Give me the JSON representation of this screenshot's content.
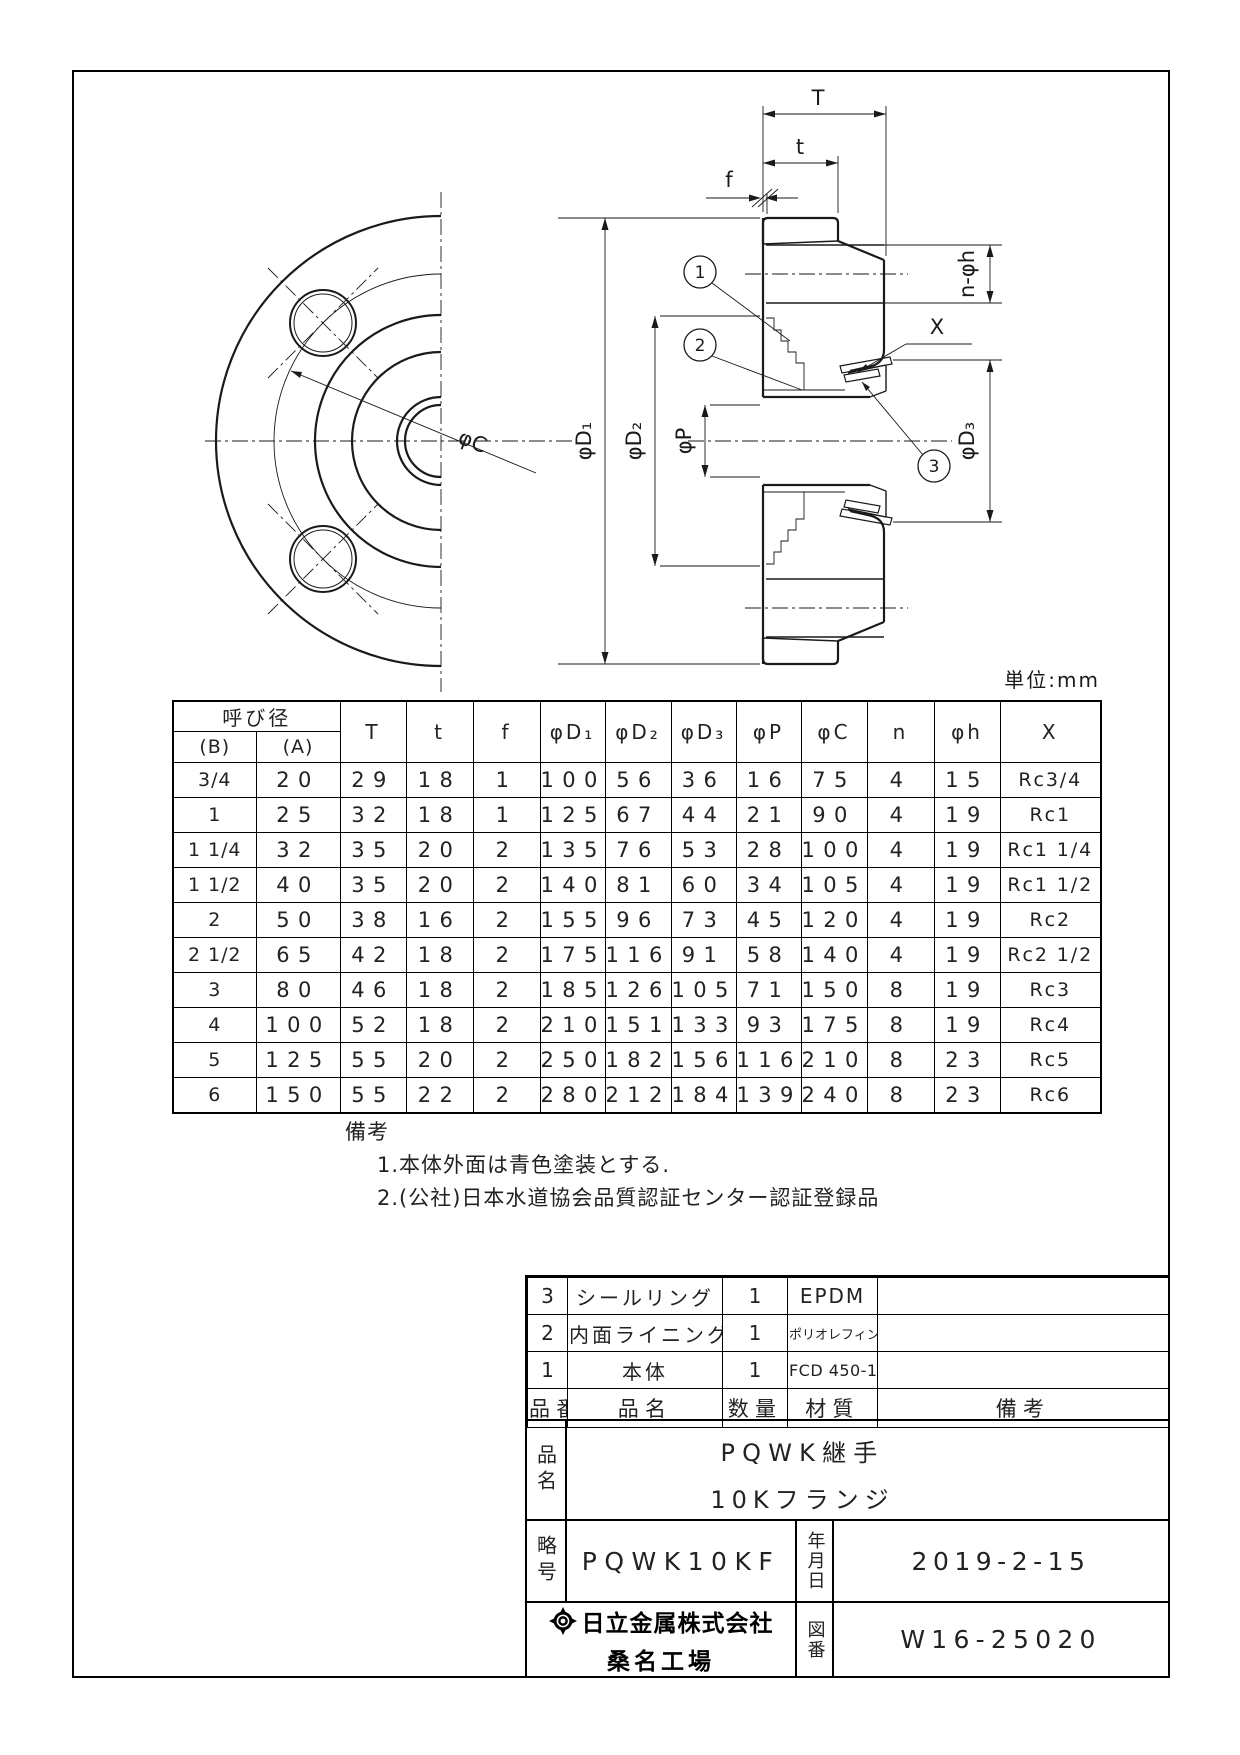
{
  "sheet": {
    "unit_note": "単位:mm"
  },
  "drawing": {
    "labels": {
      "T": "T",
      "t": "t",
      "f": "f",
      "n_phih": "n-φh",
      "X": "X",
      "phiD1": "φD₁",
      "phiD2": "φD₂",
      "phiD3": "φD₃",
      "phiP": "φP",
      "phiC": "φC"
    },
    "balloons": [
      "1",
      "2",
      "3"
    ]
  },
  "dim_table": {
    "group_header": "呼び径",
    "sub_headers": [
      "(B)",
      "(A)"
    ],
    "columns": [
      "T",
      "t",
      "f",
      "φD₁",
      "φD₂",
      "φD₃",
      "φP",
      "φC",
      "n",
      "φh",
      "X"
    ],
    "rows": [
      [
        "3/4",
        "20",
        "29",
        "18",
        "1",
        "100",
        "56",
        "36",
        "16",
        "75",
        "4",
        "15",
        "Rc3/4"
      ],
      [
        "1",
        "25",
        "32",
        "18",
        "1",
        "125",
        "67",
        "44",
        "21",
        "90",
        "4",
        "19",
        "Rc1"
      ],
      [
        "1 1/4",
        "32",
        "35",
        "20",
        "2",
        "135",
        "76",
        "53",
        "28",
        "100",
        "4",
        "19",
        "Rc1 1/4"
      ],
      [
        "1 1/2",
        "40",
        "35",
        "20",
        "2",
        "140",
        "81",
        "60",
        "34",
        "105",
        "4",
        "19",
        "Rc1 1/2"
      ],
      [
        "2",
        "50",
        "38",
        "16",
        "2",
        "155",
        "96",
        "73",
        "45",
        "120",
        "4",
        "19",
        "Rc2"
      ],
      [
        "2 1/2",
        "65",
        "42",
        "18",
        "2",
        "175",
        "116",
        "91",
        "58",
        "140",
        "4",
        "19",
        "Rc2 1/2"
      ],
      [
        "3",
        "80",
        "46",
        "18",
        "2",
        "185",
        "126",
        "105",
        "71",
        "150",
        "8",
        "19",
        "Rc3"
      ],
      [
        "4",
        "100",
        "52",
        "18",
        "2",
        "210",
        "151",
        "133",
        "93",
        "175",
        "8",
        "19",
        "Rc4"
      ],
      [
        "5",
        "125",
        "55",
        "20",
        "2",
        "250",
        "182",
        "156",
        "116",
        "210",
        "8",
        "23",
        "Rc5"
      ],
      [
        "6",
        "150",
        "55",
        "22",
        "2",
        "280",
        "212",
        "184",
        "139",
        "240",
        "8",
        "23",
        "Rc6"
      ]
    ]
  },
  "notes": {
    "title": "備考",
    "items": [
      "1.本体外面は青色塗装とする.",
      "2.(公社)日本水道協会品質認証センター認証登録品"
    ]
  },
  "parts_table": {
    "headers": [
      "品番",
      "品名",
      "数量",
      "材質",
      "備考"
    ],
    "rows": [
      [
        "3",
        "シールリング",
        "1",
        "EPDM",
        ""
      ],
      [
        "2",
        "内面ライニング",
        "1",
        "ポリオレフィン樹脂",
        ""
      ],
      [
        "1",
        "本体",
        "1",
        "FCD 450-10",
        ""
      ]
    ]
  },
  "title_block": {
    "name_label": "品名",
    "name_line1": "PQWK継手",
    "name_line2": "10Kフランジ",
    "code_label": "略号",
    "code_value": "PQWK10KF",
    "date_label": "年月日",
    "date_value": "2019-2-15",
    "company": "日立金属株式会社",
    "factory": "桑名工場",
    "dwgno_label": "図番",
    "dwgno_value": "W16-25020"
  }
}
